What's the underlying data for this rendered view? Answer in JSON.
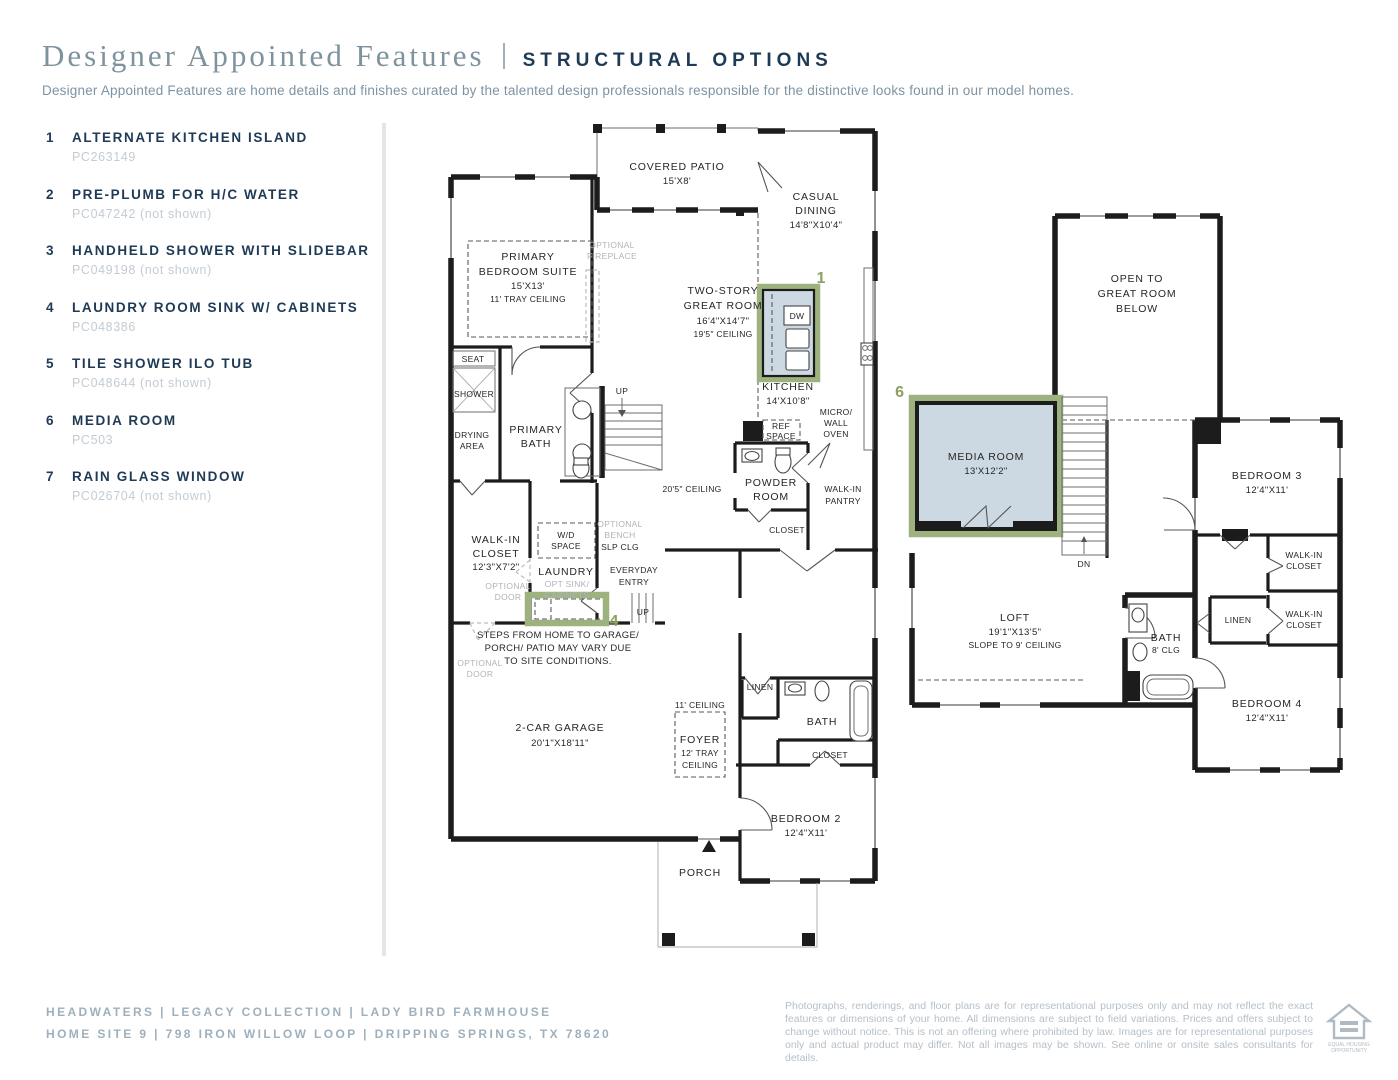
{
  "colors": {
    "navy": "#1e3a56",
    "title_gray": "#7e939e",
    "code_gray": "#c3ccd4",
    "footer_slate": "#9fb0bd",
    "plan_ink": "#1c1c1c",
    "highlight_green": "#9db27e",
    "highlight_fill": "#cdd9e2",
    "marker_green": "#8ca061"
  },
  "header": {
    "title": "Designer Appointed Features",
    "tag": "STRUCTURAL OPTIONS",
    "description": "Designer Appointed Features are home details and finishes curated by the talented design professionals responsible for the distinctive looks found in our model homes."
  },
  "features": [
    {
      "num": "1",
      "title": "ALTERNATE KITCHEN ISLAND",
      "code": "PC263149"
    },
    {
      "num": "2",
      "title": "PRE-PLUMB FOR H/C WATER",
      "code": "PC047242 (not shown)"
    },
    {
      "num": "3",
      "title": "HANDHELD SHOWER WITH SLIDEBAR",
      "code": "PC049198 (not shown)"
    },
    {
      "num": "4",
      "title": "LAUNDRY ROOM SINK W/ CABINETS",
      "code": "PC048386"
    },
    {
      "num": "5",
      "title": "TILE SHOWER ILO TUB",
      "code": "PC048644 (not shown)"
    },
    {
      "num": "6",
      "title": "MEDIA ROOM",
      "code": "PC503"
    },
    {
      "num": "7",
      "title": "RAIN GLASS WINDOW",
      "code": "PC026704 (not shown)"
    }
  ],
  "plan1": {
    "covered_patio": [
      "COVERED PATIO",
      "15'X8'"
    ],
    "casual_dining": [
      "CASUAL",
      "DINING",
      "14'8\"X10'4\""
    ],
    "primary_bedroom": [
      "PRIMARY",
      "BEDROOM SUITE",
      "15'X13'",
      "11' TRAY CEILING"
    ],
    "optional_fireplace": [
      "OPTIONAL",
      "FIREPLACE"
    ],
    "great_room": [
      "TWO-STORY",
      "GREAT ROOM",
      "16'4\"X14'7\"",
      "19'5\" CEILING"
    ],
    "marker1": "1",
    "dw": "DW",
    "kitchen": [
      "KITCHEN",
      "14'X10'8\""
    ],
    "seat": "SEAT",
    "shower": "SHOWER",
    "drying": [
      "DRYING",
      "AREA"
    ],
    "primary_bath": [
      "PRIMARY",
      "BATH"
    ],
    "up": "UP",
    "ceiling205": "20'5\" CEILING",
    "ref": [
      "REF",
      "SPACE"
    ],
    "micro": [
      "MICRO/",
      "WALL",
      "OVEN"
    ],
    "powder": [
      "POWDER",
      "ROOM"
    ],
    "pantry": [
      "WALK-IN",
      "PANTRY"
    ],
    "closet_powder": "CLOSET",
    "wic": [
      "WALK-IN",
      "CLOSET",
      "12'3\"X7'2\""
    ],
    "wd": [
      "W/D",
      "SPACE"
    ],
    "bench": [
      "OPTIONAL",
      "BENCH"
    ],
    "slp": "SLP CLG",
    "laundry": "LAUNDRY",
    "entry": [
      "EVERYDAY",
      "ENTRY"
    ],
    "optsink": [
      "OPT SINK/",
      "CABINETS"
    ],
    "marker4": "4",
    "optdoor": [
      "OPTIONAL",
      "DOOR"
    ],
    "steps": [
      "STEPS FROM HOME TO GARAGE/",
      "PORCH/ PATIO MAY VARY DUE",
      "TO SITE CONDITIONS."
    ],
    "up2": "UP",
    "garage": [
      "2-CAR GARAGE",
      "20'1\"X18'11\""
    ],
    "ceiling11": "11' CEILING",
    "foyer": [
      "FOYER",
      "12' TRAY",
      "CEILING"
    ],
    "linen": "LINEN",
    "bath": "BATH",
    "closet_bed2": "CLOSET",
    "bedroom2": [
      "BEDROOM 2",
      "12'4\"X11'"
    ],
    "porch": "PORCH"
  },
  "plan2": {
    "open_below": [
      "OPEN TO",
      "GREAT ROOM",
      "BELOW"
    ],
    "marker6": "6",
    "media": [
      "MEDIA ROOM",
      "13'X12'2\""
    ],
    "dn": "DN",
    "bedroom3": [
      "BEDROOM 3",
      "12'4\"X11'"
    ],
    "wic": [
      "WALK-IN",
      "CLOSET"
    ],
    "linen": "LINEN",
    "loft": [
      "LOFT",
      "19'1\"X13'5\"",
      "SLOPE TO 9' CEILING"
    ],
    "bath": [
      "BATH",
      "8' CLG"
    ],
    "bedroom4": [
      "BEDROOM 4",
      "12'4\"X11'"
    ]
  },
  "footer": {
    "community_line": "HEADWATERS  |  LEGACY COLLECTION  |  LADY BIRD FARMHOUSE",
    "site_line": "HOME SITE 9  |  798 IRON WILLOW LOOP  |  DRIPPING SPRINGS, TX 78620",
    "disclaimer": "Photographs, renderings, and floor plans are for representational purposes only and may not reflect the exact features or dimensions of your home. All dimensions are subject to field variations. Prices and offers subject to change without notice. This is not an offering where prohibited by law. Images are for representational purposes only and actual product may differ. Not all images may be shown. See online or onsite sales consultants for details.",
    "eho1": "EQUAL HOUSING",
    "eho2": "OPPORTUNITY"
  }
}
